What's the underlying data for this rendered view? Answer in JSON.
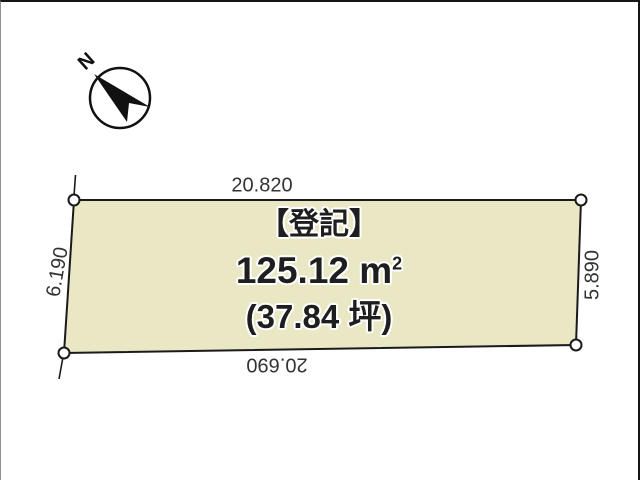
{
  "compass": {
    "north_label": "N"
  },
  "plot": {
    "fill_color": "#eae7c5",
    "outline_color": "#1a1a1a",
    "registration_title": "【登記】",
    "area_value": "125.12 m",
    "area_sup": "2",
    "area_tsubo": "(37.84 坪)",
    "dimensions": {
      "top": "20.820",
      "bottom": "20.690",
      "left": "6.190",
      "right": "5.890"
    }
  }
}
